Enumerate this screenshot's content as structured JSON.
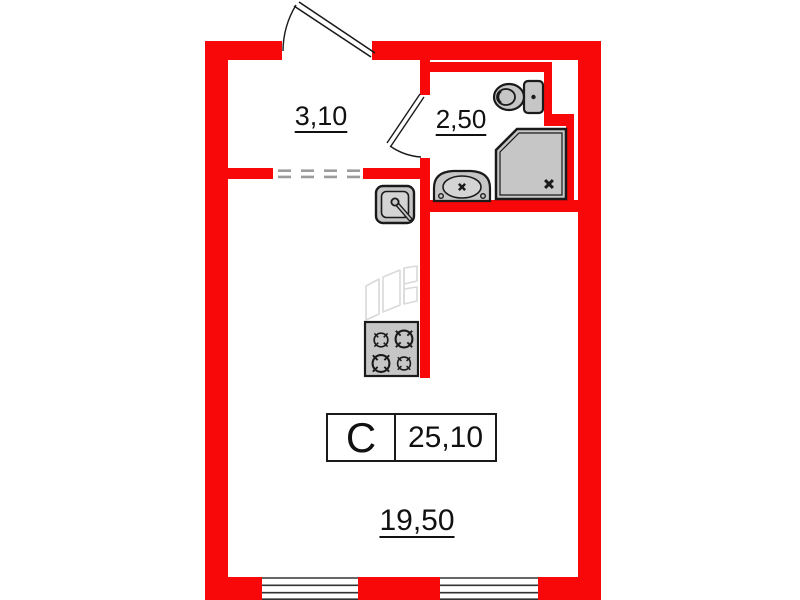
{
  "unit_card": {
    "type_label": "С",
    "total_area": "25,10"
  },
  "rooms": {
    "hallway": {
      "area": "3,10"
    },
    "bathroom": {
      "area": "2,50"
    },
    "living_room": {
      "area": "19,50"
    }
  },
  "fixtures": {
    "bathroom": [
      "toilet",
      "washbasin",
      "shower-tray"
    ],
    "kitchen": [
      "kitchen-sink",
      "stove"
    ]
  },
  "openings": [
    "entrance-door",
    "bathroom-door",
    "dashed-passage",
    "window-left",
    "window-right"
  ],
  "colors": {
    "wall": "#f80808",
    "fixture-fill": "#c6c6c6",
    "fixture-inner": "#d4d4d4",
    "fixture-stroke": "#1a1a1a",
    "sketch": "#d9d9d9",
    "dash": "#9c9c9c",
    "window-line": "#333333",
    "text": "#111111",
    "bg": "#ffffff"
  }
}
